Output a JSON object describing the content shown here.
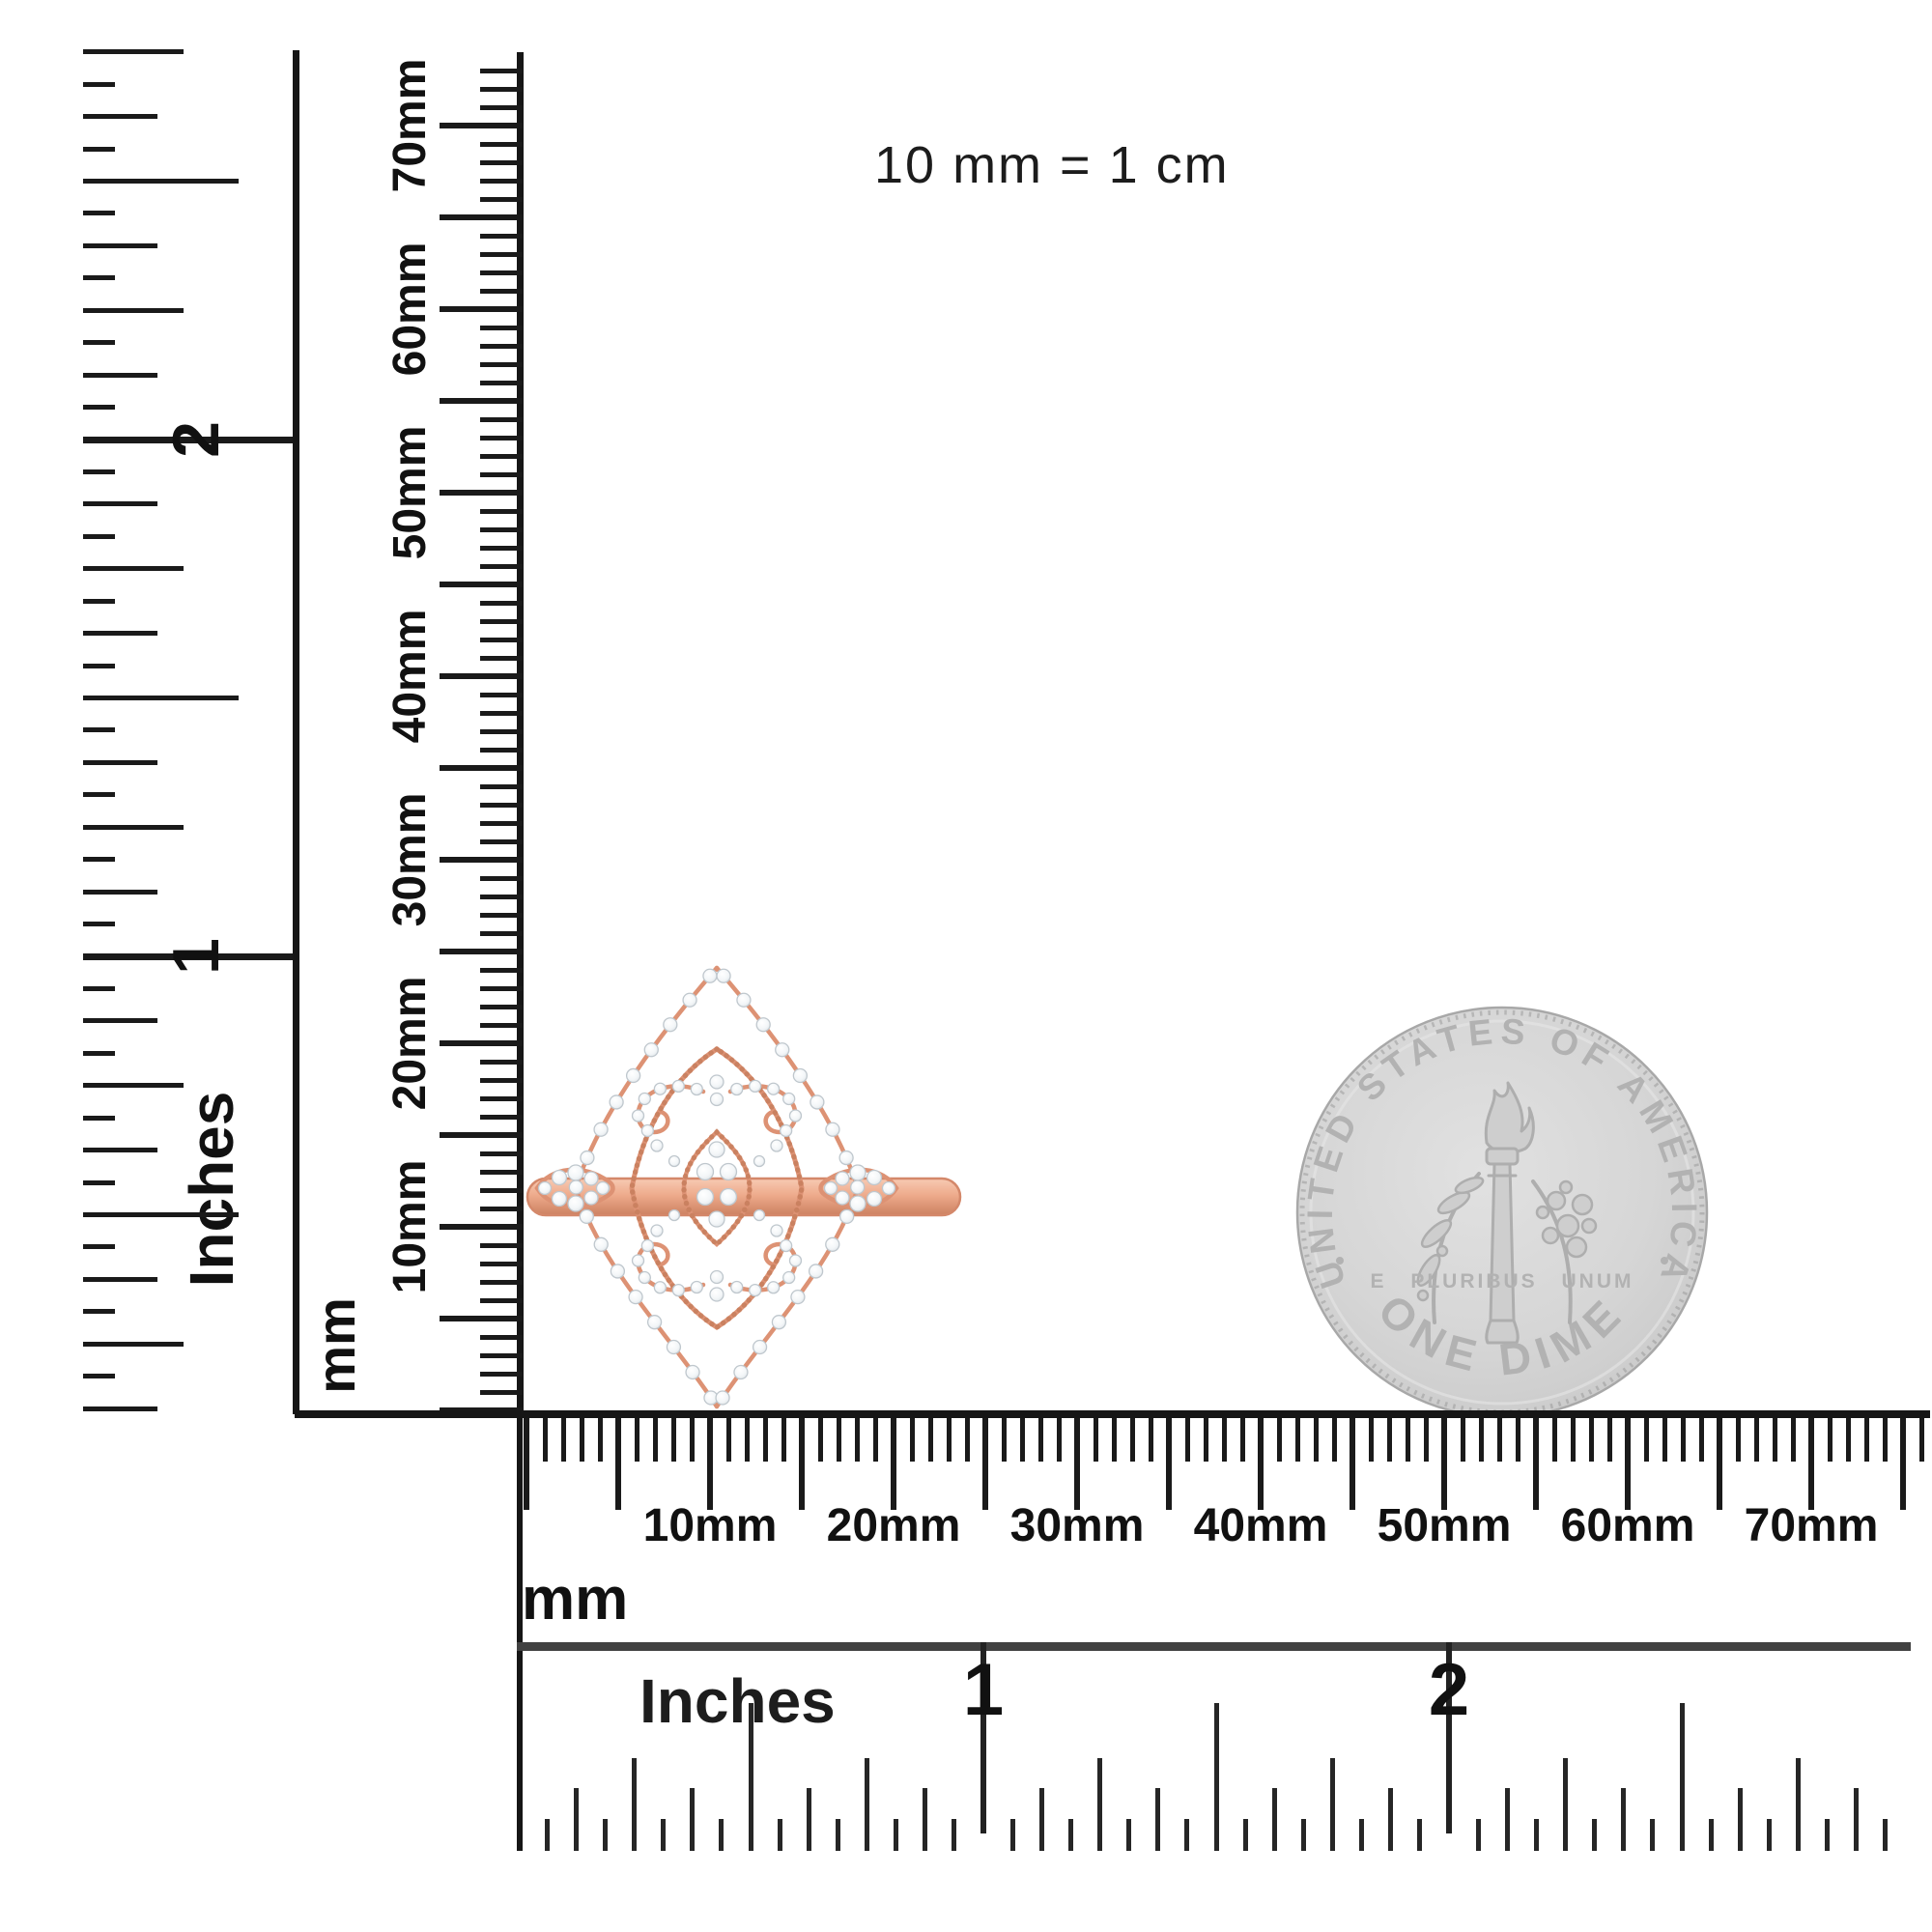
{
  "page": {
    "background": "#ffffff"
  },
  "note": {
    "text": "10 mm = 1 cm"
  },
  "rulers": {
    "left_inches": {
      "unit_label": "Inches",
      "numerals": [
        "2",
        "1"
      ]
    },
    "left_mm": {
      "unit_label": "mm",
      "labels": [
        "10mm",
        "20mm",
        "30mm",
        "40mm",
        "50mm",
        "60mm",
        "70mm"
      ]
    },
    "bottom_mm": {
      "unit_label": "mm",
      "labels": [
        "10mm",
        "20mm",
        "30mm",
        "40mm",
        "50mm",
        "60mm",
        "70mm"
      ]
    },
    "bottom_inches": {
      "unit_label": "Inches",
      "numerals": [
        "1",
        "2"
      ]
    }
  },
  "coin": {
    "kind": "US dime (reverse)",
    "top_text": "UNITED STATES OF AMERICA",
    "bottom_text": "ONE DIME",
    "middle_text": "E PLURIBUS UNUM",
    "colors": {
      "face": "#d6d6d6",
      "rim": "#a8a8a8",
      "engraving": "#b2b2b2"
    }
  },
  "ring": {
    "kind": "rose gold diamond filigree ring",
    "colors": {
      "metal": "#e09a7c",
      "metal_dark": "#c87f60",
      "metal_light": "#f6c3ab",
      "diamond": "#f7f9fa",
      "diamond_edge": "#bfc7cd"
    }
  }
}
